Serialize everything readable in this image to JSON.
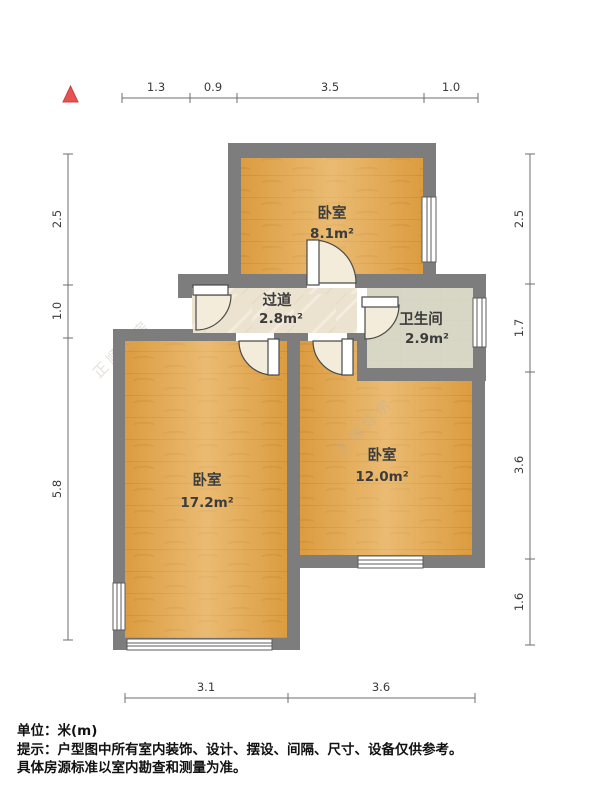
{
  "plan": {
    "type": "residential-floor-plan",
    "rooms": {
      "bedroom_top": {
        "name": "卧室",
        "area": "8.1m²"
      },
      "hallway": {
        "name": "过道",
        "area": "2.8m²"
      },
      "bathroom": {
        "name": "卫生间",
        "area": "2.9m²"
      },
      "bedroom_left": {
        "name": "卧室",
        "area": "17.2m²"
      },
      "bedroom_right": {
        "name": "卧室",
        "area": "12.0m²"
      }
    },
    "dimensions": {
      "top": [
        "1.3",
        "0.9",
        "3.5",
        "1.0"
      ],
      "left": [
        "2.5",
        "1.0",
        "5.8"
      ],
      "right": [
        "2.5",
        "1.7",
        "3.6",
        "1.6"
      ],
      "bottom": [
        "3.1",
        "3.6"
      ]
    },
    "colors": {
      "wall": "#7d7d7d",
      "wood_floor": "#dc9c40",
      "hallway_floor": "#ebe2cf",
      "bathroom_floor": "#d8d7c5",
      "north_arrow": "#e85252",
      "door_leaf": "#ffffff",
      "door_swing": "#f4ecda"
    },
    "watermark": {
      "text": "正顺好房"
    }
  },
  "footer": {
    "unit": "单位：米(m)",
    "tip_line1": "提示：户型图中所有室内装饰、设计、摆设、间隔、尺寸、设备仅供参考。",
    "tip_line2": "具体房源标准以室内勘查和测量为准。"
  }
}
